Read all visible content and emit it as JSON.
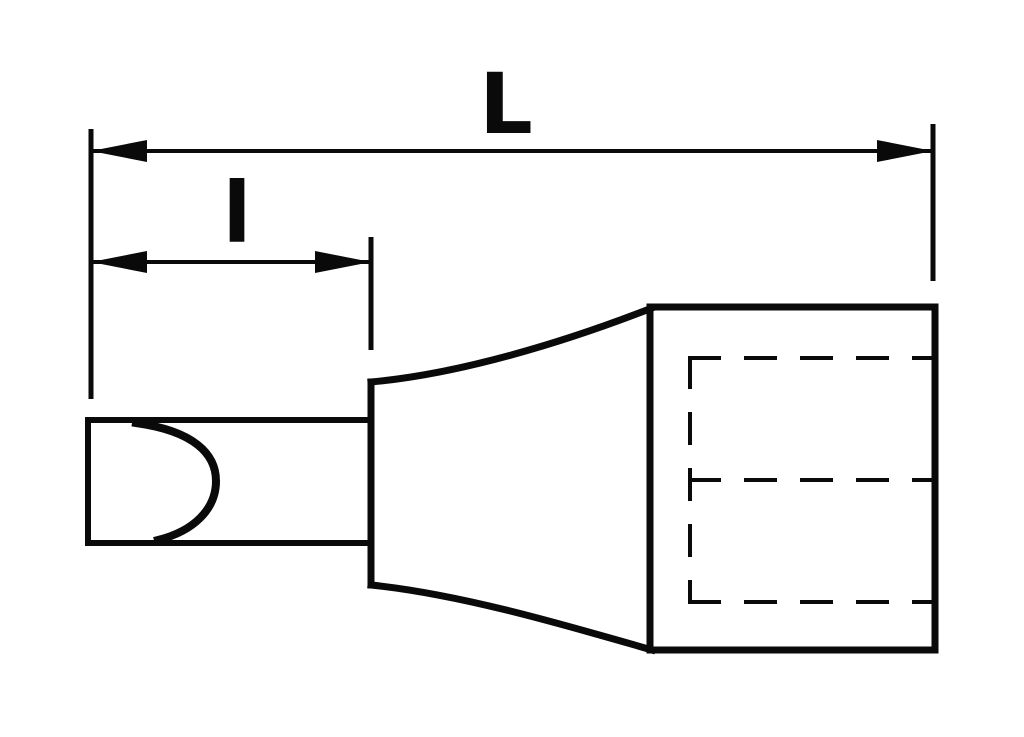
{
  "drawing": {
    "background_color": "#ffffff",
    "line_color": "#0a0a0a",
    "labels": {
      "overall_length": "L",
      "bit_length": "l"
    }
  }
}
